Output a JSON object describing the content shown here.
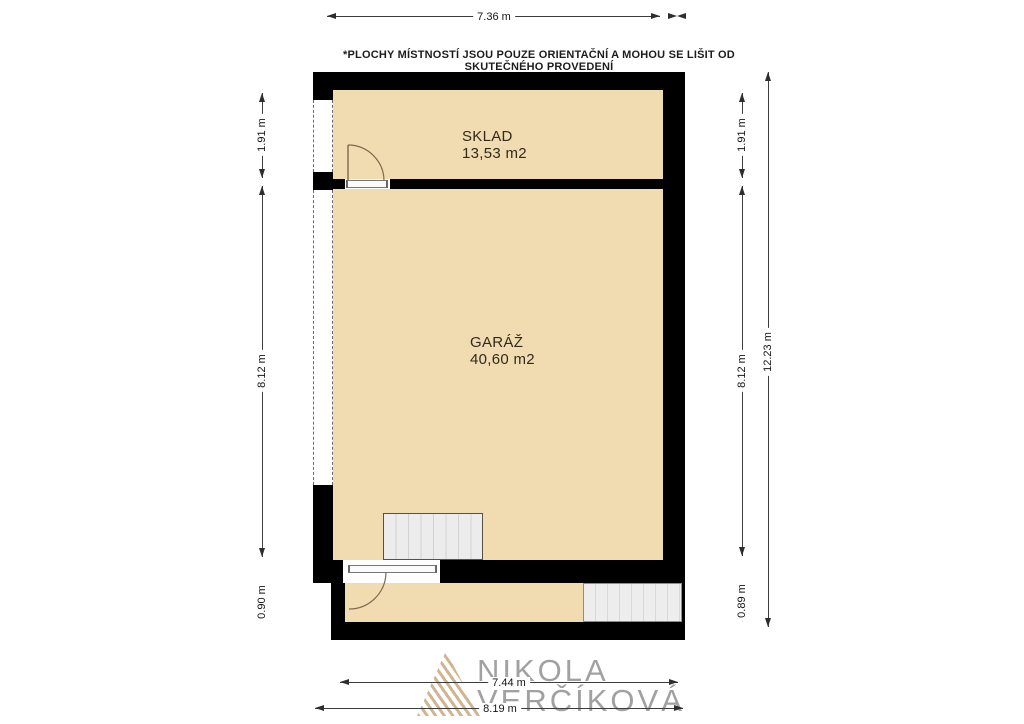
{
  "disclaimer": "*PLOCHY MÍSTNOSTÍ JSOU POUZE ORIENTAČNÍ A MOHOU SE LIŠIT OD SKUTEČNÉHO PROVEDENÍ",
  "rooms": {
    "sklad": {
      "name": "SKLAD",
      "area": "13,53 m2"
    },
    "garaz": {
      "name": "GARÁŽ",
      "area": "40,60 m2"
    }
  },
  "dimensions": {
    "top_width": "7.36 m",
    "left_sklad": "1.91 m",
    "left_garaz": "8.12 m",
    "left_entry": "0.90 m",
    "right_sklad": "1.91 m",
    "right_garaz": "8.12 m",
    "right_entry": "0.89 m",
    "right_total": "12.23 m",
    "bottom_inner": "7.44 m",
    "bottom_outer": "8.19 m"
  },
  "watermark": {
    "line1": "NIKOLA",
    "line2": "VERČÍKOVÁ"
  },
  "symbols": {
    "windows": [
      "window-sklad",
      "window-garaz"
    ],
    "doors": [
      "door-sklad",
      "door-entry"
    ],
    "stairs": [
      "stairs-garage",
      "stairs-entry"
    ]
  },
  "colors": {
    "room_fill": "#F1DBB0",
    "wall": "#000000",
    "stairs_fill": "#ECECEC",
    "logo_tan": "#C9A87E",
    "dimension_text": "#151515"
  }
}
